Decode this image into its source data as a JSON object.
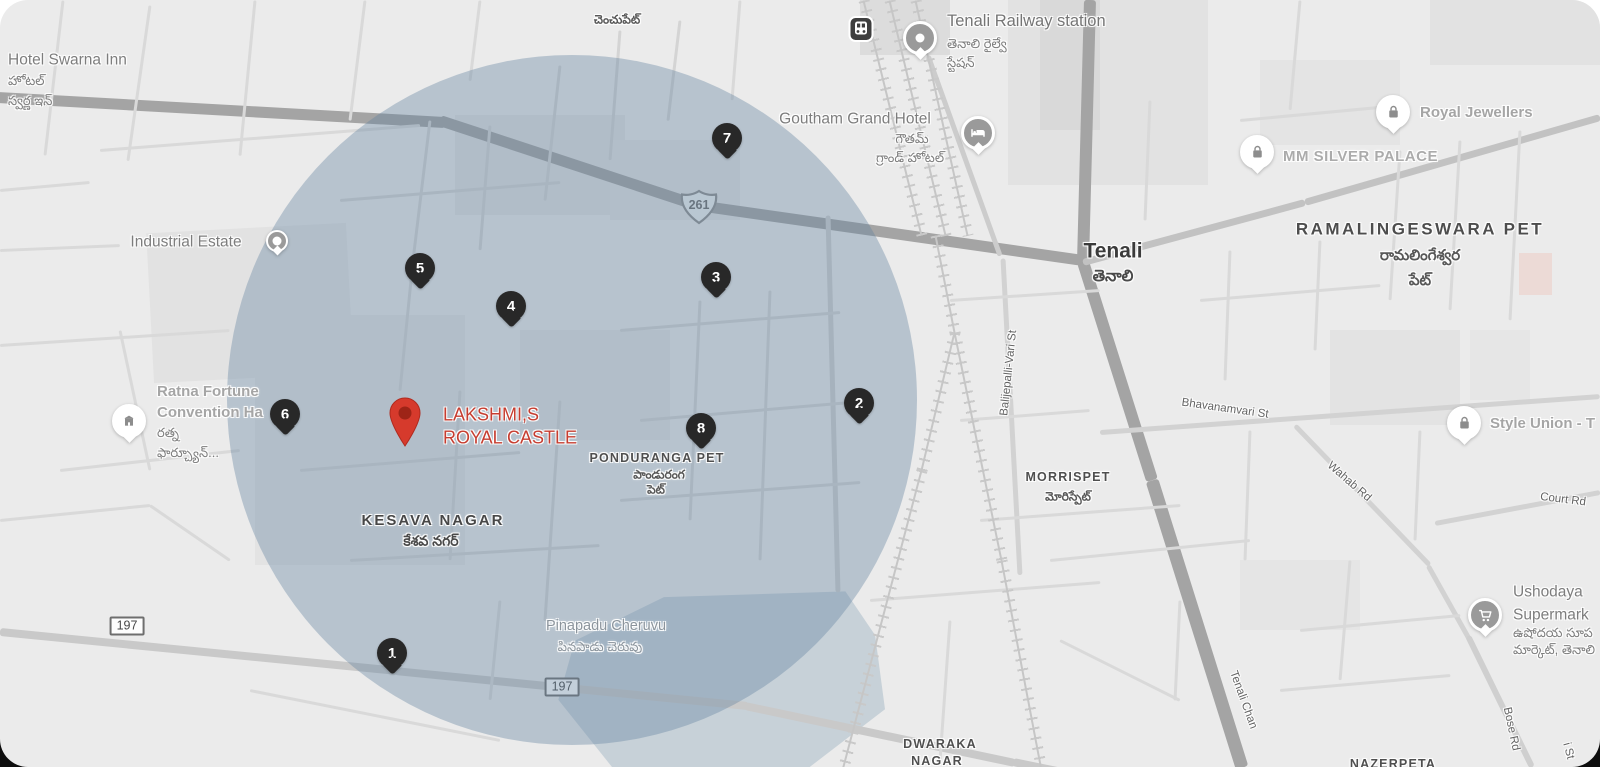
{
  "map": {
    "colors": {
      "background": "#ebebeb",
      "overlay_fill": "rgba(100,132,160,0.38)",
      "marker_black": "#282828",
      "property_red": "#d63a2c",
      "property_label_red": "#c63d30"
    },
    "overlay_circle": {
      "cx": 572,
      "cy": 400,
      "r": 345
    },
    "property": {
      "name_line1": "LAKSHMI,S",
      "name_line2": "ROYAL CASTLE",
      "pin": {
        "x": 405,
        "y": 452
      },
      "label": {
        "x": 443,
        "y": 426
      }
    },
    "numbered_markers": [
      {
        "n": "1",
        "x": 392,
        "y": 672
      },
      {
        "n": "2",
        "x": 859,
        "y": 422
      },
      {
        "n": "3",
        "x": 716,
        "y": 296
      },
      {
        "n": "4",
        "x": 511,
        "y": 325
      },
      {
        "n": "5",
        "x": 420,
        "y": 287
      },
      {
        "n": "6",
        "x": 285,
        "y": 433
      },
      {
        "n": "7",
        "x": 727,
        "y": 157
      },
      {
        "n": "8",
        "x": 701,
        "y": 447
      }
    ],
    "road_shields": [
      {
        "type": "us",
        "label": "261",
        "x": 699,
        "y": 207
      },
      {
        "type": "rect",
        "label": "197",
        "x": 127,
        "y": 626
      },
      {
        "type": "rect",
        "label": "197",
        "x": 562,
        "y": 687
      }
    ],
    "transit_badge": {
      "icon": "train",
      "x": 861,
      "y": 32
    },
    "pois": [
      {
        "name": "tenali-railway-station-pin",
        "icon": "dot",
        "variant": "gray",
        "x": 920,
        "y": 58
      },
      {
        "name": "goutham-grand-hotel-pin",
        "icon": "bed",
        "variant": "gray",
        "x": 978,
        "y": 153
      },
      {
        "name": "royal-jewellers-pin",
        "icon": "bag",
        "variant": "white",
        "x": 1393,
        "y": 132
      },
      {
        "name": "mm-silver-palace-pin",
        "icon": "bag",
        "variant": "white",
        "x": 1257,
        "y": 172
      },
      {
        "name": "style-union-pin",
        "icon": "bag",
        "variant": "white",
        "x": 1464,
        "y": 443
      },
      {
        "name": "industrial-estate-pin",
        "icon": "dot",
        "variant": "gray small",
        "x": 277,
        "y": 254
      },
      {
        "name": "ratna-fortune-pin",
        "icon": "building",
        "variant": "white",
        "x": 129,
        "y": 441
      },
      {
        "name": "ushodaya-supermarket-pin",
        "icon": "cart",
        "variant": "gray",
        "x": 1485,
        "y": 635
      }
    ],
    "labels": [
      {
        "name": "hotel-swarna-inn",
        "text": "Hotel Swarna Inn",
        "x": 8,
        "y": 60,
        "cls": "poi",
        "align": "left"
      },
      {
        "name": "hotel-swarna-inn-te-1",
        "text": "హోటల్",
        "x": 8,
        "y": 81,
        "cls": "te",
        "align": "left"
      },
      {
        "name": "hotel-swarna-inn-te-2",
        "text": "స్వర్ణ ఇన్",
        "x": 8,
        "y": 101,
        "cls": "te",
        "align": "left"
      },
      {
        "name": "chenchupet-te",
        "text": "చెంచుపేట్",
        "x": 617,
        "y": 20,
        "cls": "te-area"
      },
      {
        "name": "tenali-railway-station",
        "text": "Tenali Railway station",
        "x": 947,
        "y": 21,
        "cls": "poi-big",
        "align": "left"
      },
      {
        "name": "tenali-railway-station-te-1",
        "text": "తెనాలి రైల్వే",
        "x": 947,
        "y": 44,
        "cls": "te",
        "align": "left"
      },
      {
        "name": "tenali-railway-station-te-2",
        "text": "స్టేషన్",
        "x": 947,
        "y": 63,
        "cls": "te",
        "align": "left"
      },
      {
        "name": "goutham-grand-hotel",
        "text": "Goutham Grand Hotel",
        "x": 855,
        "y": 119,
        "cls": "poi"
      },
      {
        "name": "goutham-grand-hotel-te-1",
        "text": "గౌతమ్",
        "x": 912,
        "y": 139,
        "cls": "te"
      },
      {
        "name": "goutham-grand-hotel-te-2",
        "text": "గ్రాండ్ హోటల్",
        "x": 910,
        "y": 158,
        "cls": "te"
      },
      {
        "name": "royal-jewellers",
        "text": "Royal Jewellers",
        "x": 1420,
        "y": 113,
        "cls": "poi-light",
        "align": "left"
      },
      {
        "name": "mm-silver-palace",
        "text": "MM SILVER PALACE",
        "x": 1283,
        "y": 157,
        "cls": "shop-caps",
        "align": "left"
      },
      {
        "name": "ramalingeswara-pet",
        "text": "RAMALINGESWARA PET",
        "x": 1420,
        "y": 230,
        "cls": "district"
      },
      {
        "name": "ramalingeswara-pet-te-1",
        "text": "రామలింగేశ్వర",
        "x": 1420,
        "y": 256,
        "cls": "te-big"
      },
      {
        "name": "ramalingeswara-pet-te-2",
        "text": "పేట్",
        "x": 1420,
        "y": 281,
        "cls": "te-big"
      },
      {
        "name": "tenali-town",
        "text": "Tenali",
        "x": 1113,
        "y": 251,
        "cls": "town"
      },
      {
        "name": "tenali-town-te",
        "text": "తెనాలి",
        "x": 1113,
        "y": 277,
        "cls": "te-town"
      },
      {
        "name": "industrial-estate",
        "text": "Industrial Estate",
        "x": 186,
        "y": 242,
        "cls": "poi"
      },
      {
        "name": "ratna-fortune-1",
        "text": "Ratna Fortune",
        "x": 157,
        "y": 392,
        "cls": "poi-light",
        "align": "left"
      },
      {
        "name": "ratna-fortune-2",
        "text": "Convention Ha",
        "x": 157,
        "y": 413,
        "cls": "poi-light",
        "align": "left"
      },
      {
        "name": "ratna-fortune-te-1",
        "text": "రత్న",
        "x": 157,
        "y": 433,
        "cls": "te",
        "align": "left"
      },
      {
        "name": "ratna-fortune-te-2",
        "text": "ఫార్చ్యూన్...",
        "x": 157,
        "y": 453,
        "cls": "te",
        "align": "left"
      },
      {
        "name": "kesava-nagar",
        "text": "KESAVA NAGAR",
        "x": 433,
        "y": 521,
        "cls": "area"
      },
      {
        "name": "kesava-nagar-te",
        "text": "కేశవ నగర్",
        "x": 431,
        "y": 541,
        "cls": "te-area-big"
      },
      {
        "name": "ponduranga-pet",
        "text": "PONDURANGA PET",
        "x": 657,
        "y": 459,
        "cls": "area-sm"
      },
      {
        "name": "ponduranga-pet-te-1",
        "text": "పాండురంగ",
        "x": 659,
        "y": 475,
        "cls": "te-area"
      },
      {
        "name": "ponduranga-pet-te-2",
        "text": "పెట్",
        "x": 656,
        "y": 490,
        "cls": "te-area"
      },
      {
        "name": "morrispet",
        "text": "MORRISPET",
        "x": 1068,
        "y": 478,
        "cls": "area-sm"
      },
      {
        "name": "morrispet-te",
        "text": "మోరిస్పేట్",
        "x": 1068,
        "y": 497,
        "cls": "te-area"
      },
      {
        "name": "pinapadu-cheruvu",
        "text": "Pinapadu Cheruvu",
        "x": 606,
        "y": 627,
        "cls": "water"
      },
      {
        "name": "pinapadu-cheruvu-te",
        "text": "పినపాడు చెరువు",
        "x": 600,
        "y": 647,
        "cls": "te-water"
      },
      {
        "name": "dwaraka-nagar-1",
        "text": "DWARAKA",
        "x": 940,
        "y": 745,
        "cls": "area-sm"
      },
      {
        "name": "dwaraka-nagar-2",
        "text": "NAGAR",
        "x": 937,
        "y": 762,
        "cls": "area-sm"
      },
      {
        "name": "nazerpeta",
        "text": "NAZERPETA",
        "x": 1393,
        "y": 765,
        "cls": "area-sm"
      },
      {
        "name": "ushodaya-1",
        "text": "Ushodaya",
        "x": 1513,
        "y": 592,
        "cls": "poi",
        "align": "left"
      },
      {
        "name": "ushodaya-2",
        "text": "Supermark",
        "x": 1513,
        "y": 615,
        "cls": "poi",
        "align": "left"
      },
      {
        "name": "ushodaya-te-1",
        "text": "ఉషోదయ సూప",
        "x": 1513,
        "y": 633,
        "cls": "te",
        "align": "left"
      },
      {
        "name": "ushodaya-te-2",
        "text": "మార్కెట్, తెనాలి",
        "x": 1513,
        "y": 650,
        "cls": "te",
        "align": "left"
      },
      {
        "name": "style-union",
        "text": "Style Union - T",
        "x": 1490,
        "y": 424,
        "cls": "poi-light",
        "align": "left"
      },
      {
        "name": "balijepalli-vari-st",
        "text": "Balijepalli-Vari St",
        "x": 1009,
        "y": 373,
        "cls": "road-lbl",
        "rot": -84
      },
      {
        "name": "bhavanamvari-st",
        "text": "Bhavanamvari St",
        "x": 1225,
        "y": 409,
        "cls": "road-lbl",
        "rot": 8
      },
      {
        "name": "wahab-rd",
        "text": "Wahab Rd",
        "x": 1349,
        "y": 482,
        "cls": "road-lbl",
        "rot": 41
      },
      {
        "name": "court-rd",
        "text": "Court Rd",
        "x": 1563,
        "y": 500,
        "cls": "road-lbl",
        "rot": 7
      },
      {
        "name": "bose-rd",
        "text": "Bose Rd",
        "x": 1511,
        "y": 729,
        "cls": "road-lbl",
        "rot": 78
      },
      {
        "name": "tenali-chan-rd",
        "text": "Tenali Chan",
        "x": 1243,
        "y": 700,
        "cls": "road-lbl",
        "rot": 70
      },
      {
        "name": "i-st",
        "text": "i St",
        "x": 1568,
        "y": 751,
        "cls": "road-lbl",
        "rot": 75
      }
    ]
  }
}
